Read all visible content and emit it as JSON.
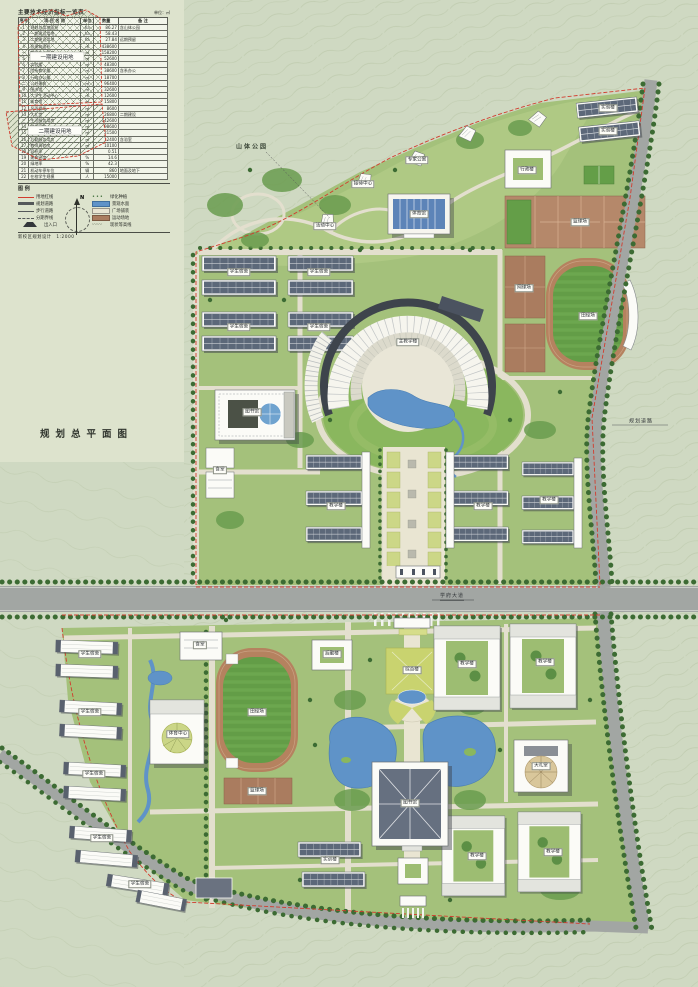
{
  "meta": {
    "drawing_title": "规划总平面图"
  },
  "panel": {
    "table": {
      "title": "主要技术经济指标一览表",
      "unit_note": "单位：㎡",
      "headers": [
        "序号",
        "项 目 名 称",
        "单位",
        "数量",
        "备 注"
      ],
      "rows": [
        [
          "1",
          "规划总用地面积",
          "ha",
          "86.27",
          "含山体公园"
        ],
        [
          "2",
          "一期建设用地",
          "ha",
          "58.43",
          ""
        ],
        [
          "3",
          "二期建设用地",
          "ha",
          "27.84",
          "远期预留"
        ],
        [
          "4",
          "总建筑面积",
          "㎡",
          "438600",
          ""
        ],
        [
          "一",
          "教学办公用房",
          "㎡",
          "158200",
          ""
        ],
        [
          "5",
          "公共教学楼",
          "㎡",
          "52600",
          ""
        ],
        [
          "6",
          "实验楼",
          "㎡",
          "48300",
          ""
        ],
        [
          "7",
          "院系教学楼",
          "㎡",
          "38600",
          "含系办公"
        ],
        [
          "8",
          "行政办公楼",
          "㎡",
          "18700",
          ""
        ],
        [
          "二",
          "公共建筑",
          "㎡",
          "96400",
          ""
        ],
        [
          "9",
          "图书馆",
          "㎡",
          "32600",
          ""
        ],
        [
          "10",
          "大学生活动中心",
          "㎡",
          "12600",
          ""
        ],
        [
          "11",
          "体育馆",
          "㎡",
          "15800",
          ""
        ],
        [
          "12",
          "风雨操场",
          "㎡",
          "8600",
          ""
        ],
        [
          "13",
          "大礼堂",
          "㎡",
          "26800",
          "二期建设"
        ],
        [
          "三",
          "生活服务用房",
          "㎡",
          "142600",
          ""
        ],
        [
          "14",
          "学生宿舍",
          "㎡",
          "98600",
          ""
        ],
        [
          "15",
          "学生食堂",
          "㎡",
          "21500",
          ""
        ],
        [
          "16",
          "后勤服务用房",
          "㎡",
          "12400",
          "含浴室"
        ],
        [
          "17",
          "教师周转房",
          "㎡",
          "10100",
          ""
        ],
        [
          "18",
          "容积率",
          "—",
          "0.51",
          ""
        ],
        [
          "19",
          "建筑密度",
          "%",
          "14.6",
          ""
        ],
        [
          "20",
          "绿地率",
          "%",
          "42.3",
          ""
        ],
        [
          "21",
          "机动车停车位",
          "辆",
          "860",
          "地面及地下"
        ],
        [
          "22",
          "在校学生规模",
          "人",
          "15000",
          ""
        ]
      ]
    },
    "legend": {
      "title": "图 例",
      "items": [
        {
          "symbol": "redline",
          "label": "用地红线"
        },
        {
          "symbol": "tree",
          "label": "绿化种植"
        },
        {
          "symbol": "road",
          "label": "规划道路"
        },
        {
          "symbol": "water",
          "label": "景观水面"
        },
        {
          "symbol": "path",
          "label": "步行道路"
        },
        {
          "symbol": "plaza",
          "label": "广场铺装"
        },
        {
          "symbol": "dash",
          "label": "分期界线"
        },
        {
          "symbol": "court",
          "label": "运动场地"
        },
        {
          "symbol": "gate",
          "label": "出入口"
        },
        {
          "symbol": "contour",
          "label": "现状等高线"
        }
      ]
    },
    "compass_label": "N",
    "note": "新校区规划设计　1:2000",
    "key_diagram": {
      "phase1": "一期建设用地",
      "phase2": "二期建设用地"
    }
  },
  "map": {
    "area_labels": [
      {
        "t": "山体公园",
        "x": 252,
        "y": 146
      }
    ],
    "road_labels": [
      {
        "t": "学府大道",
        "x": 452,
        "y": 596,
        "u": true
      },
      {
        "t": "规划道路",
        "x": 641,
        "y": 421,
        "u": false
      }
    ],
    "building_labels": [
      {
        "t": "体育馆",
        "x": 419,
        "y": 214
      },
      {
        "t": "行政楼",
        "x": 527,
        "y": 170
      },
      {
        "t": "实验楼",
        "x": 608,
        "y": 108
      },
      {
        "t": "实验楼",
        "x": 608,
        "y": 131
      },
      {
        "t": "篮球场",
        "x": 580,
        "y": 222
      },
      {
        "t": "网球场",
        "x": 524,
        "y": 288
      },
      {
        "t": "田径场",
        "x": 588,
        "y": 316
      },
      {
        "t": "学生宿舍",
        "x": 239,
        "y": 272
      },
      {
        "t": "学生宿舍",
        "x": 239,
        "y": 327
      },
      {
        "t": "学生宿舍",
        "x": 319,
        "y": 272
      },
      {
        "t": "学生宿舍",
        "x": 319,
        "y": 327
      },
      {
        "t": "图书馆",
        "x": 252,
        "y": 412
      },
      {
        "t": "主教学楼",
        "x": 408,
        "y": 342
      },
      {
        "t": "教学楼",
        "x": 336,
        "y": 506
      },
      {
        "t": "教学楼",
        "x": 483,
        "y": 506
      },
      {
        "t": "教学楼",
        "x": 549,
        "y": 500
      },
      {
        "t": "食堂",
        "x": 220,
        "y": 470
      },
      {
        "t": "专家公寓",
        "x": 417,
        "y": 160
      },
      {
        "t": "接待中心",
        "x": 363,
        "y": 184
      },
      {
        "t": "活动中心",
        "x": 325,
        "y": 226
      },
      {
        "t": "学生宿舍",
        "x": 90,
        "y": 654
      },
      {
        "t": "学生宿舍",
        "x": 90,
        "y": 712
      },
      {
        "t": "学生宿舍",
        "x": 94,
        "y": 774
      },
      {
        "t": "学生宿舍",
        "x": 102,
        "y": 838
      },
      {
        "t": "食堂",
        "x": 200,
        "y": 645
      },
      {
        "t": "体育中心",
        "x": 178,
        "y": 734
      },
      {
        "t": "田径场",
        "x": 257,
        "y": 712
      },
      {
        "t": "篮球场",
        "x": 257,
        "y": 791
      },
      {
        "t": "综合楼",
        "x": 412,
        "y": 670
      },
      {
        "t": "教学楼",
        "x": 467,
        "y": 664
      },
      {
        "t": "教学楼",
        "x": 545,
        "y": 662
      },
      {
        "t": "图书馆",
        "x": 410,
        "y": 803
      },
      {
        "t": "大礼堂",
        "x": 541,
        "y": 766
      },
      {
        "t": "教学楼",
        "x": 477,
        "y": 856
      },
      {
        "t": "教学楼",
        "x": 553,
        "y": 852
      },
      {
        "t": "实训楼",
        "x": 330,
        "y": 860
      },
      {
        "t": "后勤楼",
        "x": 332,
        "y": 654
      },
      {
        "t": "学生宿舍",
        "x": 140,
        "y": 884
      }
    ]
  },
  "colors": {
    "boundary_red": "#d23c2e",
    "water": "#5f93c8",
    "road": "#a2a6a3",
    "track": "#b5825f",
    "court": "#aa7c5f",
    "lawn": "#a4c17b",
    "roof_blue": "#5d84b8",
    "roof_dark": "#5c6879",
    "paper": "#cfd9c2"
  }
}
